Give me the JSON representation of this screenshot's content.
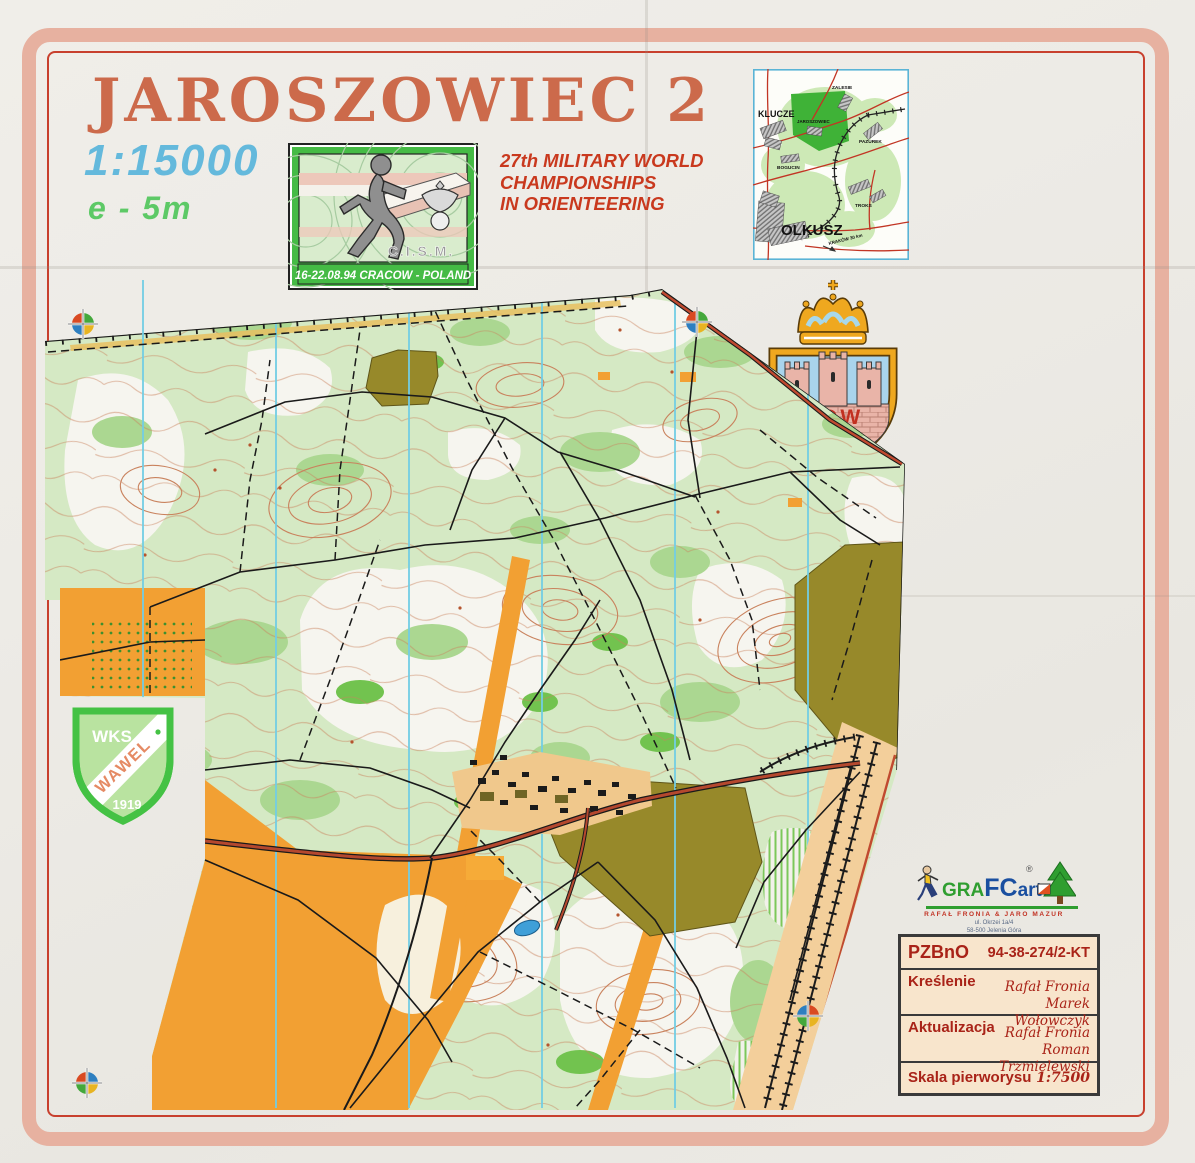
{
  "document": {
    "title": "JAROSZOWIEC 2",
    "scale": "1:15000",
    "contour_interval": "e - 5m"
  },
  "championship": {
    "line1": "27th MILITARY WORLD",
    "line2": "CHAMPIONSHIPS",
    "line3": "IN ORIENTEERING"
  },
  "cism": {
    "acronym": "C.I.S.M.",
    "banner": "16-22.08.94  CRACOW - POLAND"
  },
  "inset": {
    "klucze": "KLUCZE",
    "zalesie": "ZALESIE",
    "jaroszowiec": "JAROSZOWIEC",
    "pazurek": "PAZUREK",
    "bogucin": "BOGUCIN",
    "troks": "TROKS",
    "olkusz": "OLKUSZ",
    "krakow": "KRAKÓW  30 km"
  },
  "arms": {
    "motto": "KOW"
  },
  "club": {
    "org": "WKS",
    "name": "WAWEL",
    "year": "1919"
  },
  "grafcart": {
    "gra": "GRA",
    "fc": "FC",
    "art": "art",
    "registered": "®",
    "authors": "RAFAŁ FRONIA   &   JARO MAZUR",
    "address1": "ul. Okrzei 1a/4",
    "address2": "58-500 Jelenia Góra"
  },
  "credits": {
    "r1_label": "PZBnO",
    "r1_value": "94-38-274/2-KT",
    "r2_label": "Kreślenie",
    "r2_name1": "Rafał Fronia",
    "r2_name2": "Marek Wołowczyk",
    "r3_label": "Aktualizacja",
    "r3_name1": "Rafał Fronia",
    "r3_name2": "Roman Trzmielewski",
    "r4_label": "Skala pierworysu",
    "r4_value": "1:7500"
  },
  "colors": {
    "paper": "#edebe6",
    "frame": "#e7b1a0",
    "frame_line": "#c8402e",
    "title_red": "#cc6a4b",
    "scale_blue": "#64b9dc",
    "contour_green": "#5dc966",
    "championship_red": "#c9391e",
    "forest_light_green": "#d5e9c4",
    "forest_white": "#f6f5ef",
    "green_medium": "#abd791",
    "green_dark": "#72c34f",
    "open_orange": "#f2a033",
    "out_of_bounds_olive": "#97892a",
    "contour_brown": "#c9825d",
    "north_line_blue": "#72cde4",
    "road_red": "#b5482e",
    "railway_corridor_tan": "#f3cf9b",
    "credits_red": "#a92318"
  }
}
